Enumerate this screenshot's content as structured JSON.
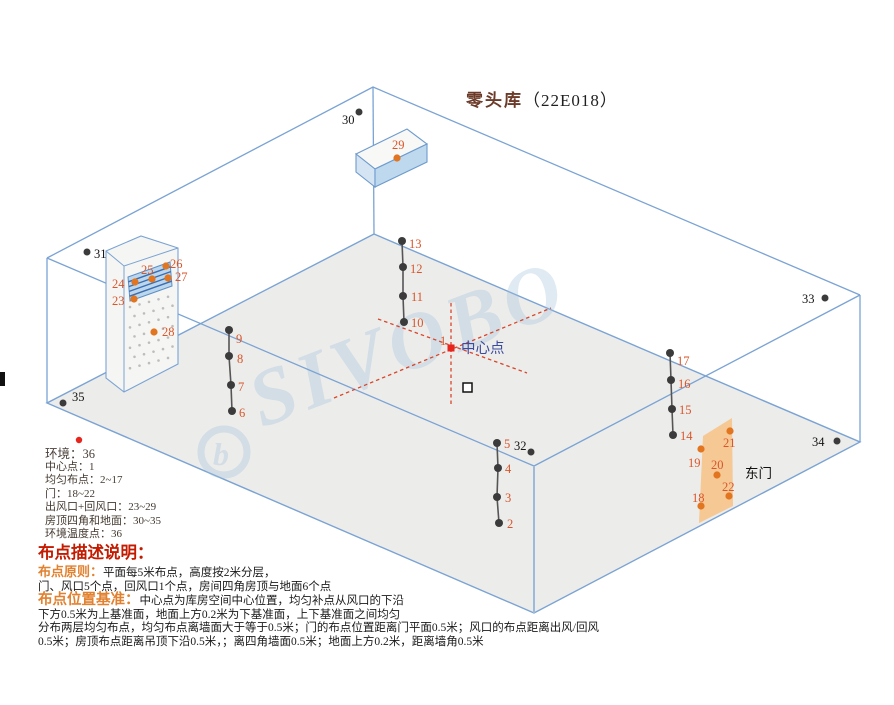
{
  "title": {
    "name": "零头库",
    "code": "（22E018）"
  },
  "watermark": {
    "text": "SIVOBO",
    "logo_letter": "b"
  },
  "env_line": "环境：36",
  "center_label": "中心点",
  "door_label": "东门",
  "legend_items": [
    "中心点：1",
    "均匀布点：2~17",
    "门：18~22",
    "出风口+回风口：23~29",
    "房顶四角和地面：30~35",
    "环境温度点：36"
  ],
  "notes": {
    "heading": "布点描述说明：",
    "principle_label": "布点原则：",
    "principle_line1": "平面每5米布点，高度按2米分层，",
    "principle_line2": "门、风口5个点，回风口1个点，房间四角房顶与地面6个点",
    "basis_label": "布点位置基准：",
    "basis_line1": "中心点为库房空间中心位置，均匀补点从风口的下沿",
    "basis_line2": "下方0.5米为上基准面，地面上方0.2米为下基准面，上下基准面之间均匀",
    "basis_line3": "分布两层均匀布点，均匀布点离墙面大于等于0.5米；门的布点位置距离门平面0.5米；风口的布点距离出风/回风",
    "basis_line4": "0.5米；房顶布点距离吊顶下沿0.5米，；离四角墙面0.5米；地面上方0.2米，距离墙角0.5米"
  },
  "colors": {
    "room_line_blue": "#7aa3d4",
    "floor_fill": "#ececea",
    "point_orange": "#e2751f",
    "label_orange": "#d9562a",
    "dark_dot": "#3b3b3b",
    "corner_label": "#141414",
    "center_red": "#e8251c",
    "center_blue": "#3c4aa0",
    "dash_red": "#d9452b",
    "door_fill": "#f6c48b",
    "chain_line": "#555555"
  },
  "points": {
    "center": {
      "n": "1",
      "x": 451,
      "y": 348,
      "lx": 440,
      "ly": 345,
      "text_x": 461,
      "text_y": 353
    },
    "chains": [
      {
        "name": "chain-2-5",
        "dots": [
          {
            "n": "5",
            "x": 497,
            "y": 443,
            "lx": 504,
            "ly": 448
          },
          {
            "n": "4",
            "x": 498,
            "y": 468,
            "lx": 505,
            "ly": 473
          },
          {
            "n": "3",
            "x": 497,
            "y": 497,
            "lx": 505,
            "ly": 502
          },
          {
            "n": "2",
            "x": 499,
            "y": 523,
            "lx": 507,
            "ly": 528
          }
        ]
      },
      {
        "name": "chain-6-9",
        "dots": [
          {
            "n": "9",
            "x": 229,
            "y": 330,
            "lx": 236,
            "ly": 343
          },
          {
            "n": "8",
            "x": 229,
            "y": 356,
            "lx": 237,
            "ly": 363
          },
          {
            "n": "7",
            "x": 231,
            "y": 385,
            "lx": 238,
            "ly": 391
          },
          {
            "n": "6",
            "x": 232,
            "y": 411,
            "lx": 239,
            "ly": 417
          }
        ]
      },
      {
        "name": "chain-10-13",
        "dots": [
          {
            "n": "13",
            "x": 402,
            "y": 241,
            "lx": 409,
            "ly": 248
          },
          {
            "n": "12",
            "x": 403,
            "y": 267,
            "lx": 410,
            "ly": 273
          },
          {
            "n": "11",
            "x": 403,
            "y": 296,
            "lx": 411,
            "ly": 301
          },
          {
            "n": "10",
            "x": 404,
            "y": 322,
            "lx": 411,
            "ly": 327
          }
        ]
      },
      {
        "name": "chain-14-17",
        "dots": [
          {
            "n": "17",
            "x": 670,
            "y": 353,
            "lx": 677,
            "ly": 365
          },
          {
            "n": "16",
            "x": 671,
            "y": 380,
            "lx": 678,
            "ly": 388
          },
          {
            "n": "15",
            "x": 672,
            "y": 409,
            "lx": 679,
            "ly": 414
          },
          {
            "n": "14",
            "x": 673,
            "y": 435,
            "lx": 680,
            "ly": 440
          }
        ]
      }
    ],
    "vent_points": [
      {
        "n": "23",
        "x": 134,
        "y": 299,
        "lx": 112,
        "ly": 305
      },
      {
        "n": "24",
        "x": 135,
        "y": 282,
        "lx": 112,
        "ly": 288
      },
      {
        "n": "25",
        "x": 152,
        "y": 279,
        "lx": 141,
        "ly": 274
      },
      {
        "n": "26",
        "x": 166,
        "y": 266,
        "lx": 170,
        "ly": 268
      },
      {
        "n": "27",
        "x": 168,
        "y": 278,
        "lx": 175,
        "ly": 281
      },
      {
        "n": "28",
        "x": 154,
        "y": 332,
        "lx": 162,
        "ly": 336
      },
      {
        "n": "29",
        "x": 397,
        "y": 158,
        "lx": 392,
        "ly": 149
      }
    ],
    "door_points": [
      {
        "n": "18",
        "x": 701,
        "y": 506,
        "lx": 692,
        "ly": 502
      },
      {
        "n": "19",
        "x": 701,
        "y": 449,
        "lx": 688,
        "ly": 467
      },
      {
        "n": "20",
        "x": 717,
        "y": 475,
        "lx": 711,
        "ly": 469
      },
      {
        "n": "21",
        "x": 730,
        "y": 431,
        "lx": 723,
        "ly": 447
      },
      {
        "n": "22",
        "x": 729,
        "y": 496,
        "lx": 722,
        "ly": 491
      }
    ],
    "corner_points": [
      {
        "n": "30",
        "x": 359,
        "y": 112,
        "lx": 342,
        "ly": 124
      },
      {
        "n": "31",
        "x": 87,
        "y": 252,
        "lx": 94,
        "ly": 258
      },
      {
        "n": "32",
        "x": 531,
        "y": 452,
        "lx": 514,
        "ly": 450
      },
      {
        "n": "33",
        "x": 825,
        "y": 298,
        "lx": 802,
        "ly": 303
      },
      {
        "n": "34",
        "x": 837,
        "y": 441,
        "lx": 812,
        "ly": 446
      },
      {
        "n": "35",
        "x": 63,
        "y": 403,
        "lx": 72,
        "ly": 401
      }
    ],
    "env_dot": {
      "x": 79,
      "y": 440
    }
  }
}
